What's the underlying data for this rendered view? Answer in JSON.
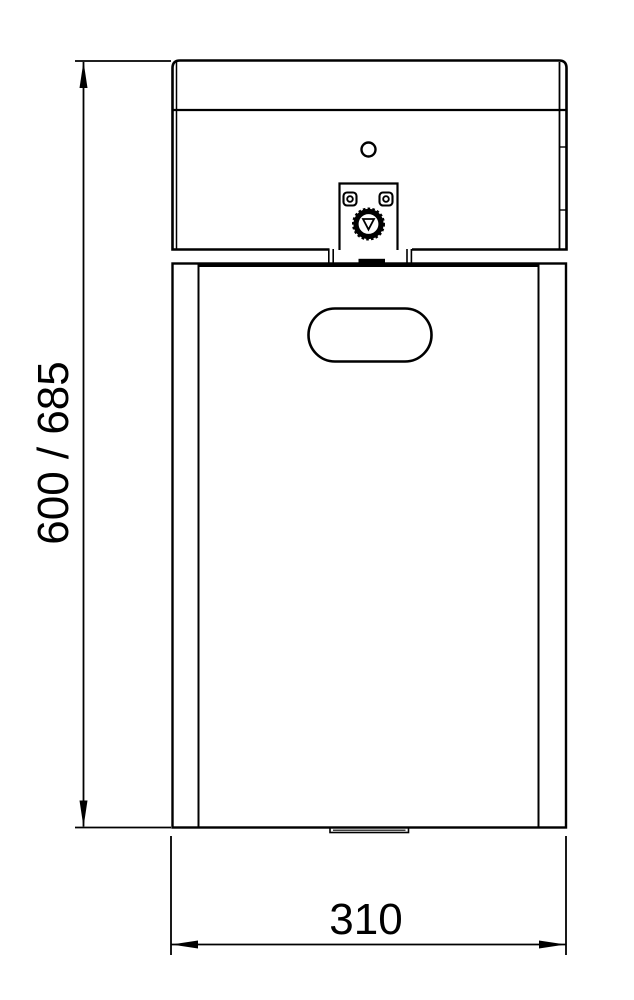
{
  "page": {
    "background_color": "#ffffff",
    "line_color": "#000000",
    "text_color": "#000000"
  },
  "drawing": {
    "kind": "technical dimension drawing",
    "view": "front elevation of wall-mounted bin with lid, lock and handle slot",
    "labels": {
      "height": "600 / 685",
      "width": "310"
    }
  }
}
